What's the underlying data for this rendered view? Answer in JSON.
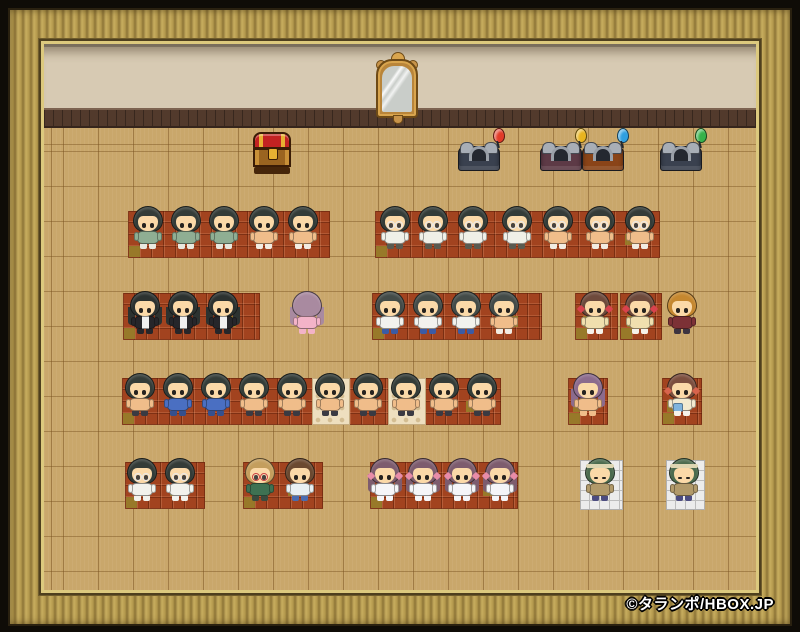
{
  "game": {
    "copyright": "©タランポ/HBOX.JP"
  },
  "palette": {
    "outer_bg": "#0f0c07",
    "frame_gold": "#b4994d",
    "wall": "#d7cab3",
    "baseboard": "#523a2c",
    "floor": "#c9a76b",
    "red_tile": "#a2431f",
    "olive_tile": "#97802a",
    "cream_tile": "#eedfbf",
    "white_mat": "#ececec",
    "skin": "#f5cb98"
  },
  "objects": {
    "mirror": {
      "name": "wall-mirror",
      "x": 374,
      "y": 50
    },
    "chest": {
      "name": "treasure-chest",
      "x": 253,
      "y": 132
    },
    "beds": [
      {
        "x": 457,
        "y": 140,
        "base": "#3a414f",
        "marker_color": "#e23b28",
        "marker_icon": "red-balloon-icon"
      },
      {
        "x": 539,
        "y": 140,
        "base": "#5d3a46",
        "marker_color": "#e9b41f",
        "marker_icon": "yellow-balloon-icon"
      },
      {
        "x": 581,
        "y": 140,
        "base": "#8a4418",
        "marker_color": "#2f9fe0",
        "marker_icon": "blue-balloon-icon"
      },
      {
        "x": 659,
        "y": 140,
        "base": "#3a414f",
        "marker_color": "#35b24a",
        "marker_icon": "green-balloon-icon"
      }
    ]
  },
  "tiles": {
    "red_blocks": [
      {
        "x": 128,
        "y": 211,
        "w": 202,
        "h": 47
      },
      {
        "x": 375,
        "y": 211,
        "w": 285,
        "h": 47
      },
      {
        "x": 123,
        "y": 293,
        "w": 137,
        "h": 47
      },
      {
        "x": 372,
        "y": 293,
        "w": 170,
        "h": 47
      },
      {
        "x": 575,
        "y": 293,
        "w": 43,
        "h": 47
      },
      {
        "x": 620,
        "y": 293,
        "w": 42,
        "h": 47
      },
      {
        "x": 122,
        "y": 378,
        "w": 379,
        "h": 47
      },
      {
        "x": 568,
        "y": 378,
        "w": 40,
        "h": 47
      },
      {
        "x": 662,
        "y": 378,
        "w": 40,
        "h": 47
      },
      {
        "x": 125,
        "y": 462,
        "w": 80,
        "h": 47
      },
      {
        "x": 243,
        "y": 462,
        "w": 80,
        "h": 47
      },
      {
        "x": 370,
        "y": 462,
        "w": 148,
        "h": 47
      }
    ],
    "cream_tiles": [
      {
        "x": 312,
        "y": 378,
        "w": 38,
        "h": 47
      },
      {
        "x": 388,
        "y": 378,
        "w": 38,
        "h": 47
      }
    ],
    "white_mats": [
      {
        "x": 580,
        "y": 460,
        "w": 43,
        "h": 50
      },
      {
        "x": 666,
        "y": 460,
        "w": 39,
        "h": 50
      }
    ]
  },
  "sprites": {
    "rows": {
      "1": 206,
      "2": 291,
      "3": 373,
      "4": 458
    },
    "skin": "#f5cb98",
    "face": "#fbd9a8",
    "types": {
      "boy_green": {
        "hair": "#343c38",
        "top": "#8fae93",
        "legs": "#e9e9df"
      },
      "boy_shirtless": {
        "hair": "#343c38",
        "top": "#f0bd8a",
        "legs": "#f2ece2"
      },
      "glasses_clothed": {
        "hair": "#343c38",
        "glasses": "#e8e8e8",
        "top": "#f0f0e8",
        "legs": "#5a5a50"
      },
      "glasses_shirtless": {
        "hair": "#343c38",
        "glasses": "#e8e8e8",
        "top": "#f0bd8a",
        "legs": "#f2ece2"
      },
      "suit": {
        "hair": "#2c3230",
        "long": true,
        "top": "#26262a",
        "stripe": "#f0f0f0",
        "legs": "#26262a"
      },
      "pink_back": {
        "hair": "#a98aa0",
        "back": true,
        "long": true,
        "top": "#f3b3c8",
        "legs": "#f3b3c8"
      },
      "tee_jeans": {
        "hair": "#434b48",
        "top": "#f2f2ee",
        "legs": "#3b5ba5"
      },
      "gray_shirtless": {
        "hair": "#434b48",
        "top": "#f0bd8a",
        "legs": "#f2ece2"
      },
      "yellow_dress": {
        "hair": "#6e4a3c",
        "ribbon": "#d8434d",
        "top": "#f0dfae",
        "legs": "#f6f2ea"
      },
      "gold_spiky": {
        "hair": "#c5872f",
        "top": "#7c3136",
        "legs": "#3c3440"
      },
      "blue_jacket": {
        "hair": "#343c38",
        "top": "#4a6fc2",
        "legs": "#35508e"
      },
      "dark_shirtless": {
        "hair": "#343c38",
        "top": "#f0bd8a",
        "legs": "#3a3a42"
      },
      "purple_long": {
        "hair": "#8c6b8d",
        "long": true,
        "top": "#f0bd8a",
        "legs": "#f0bd8a"
      },
      "pigtail_girl": {
        "hair": "#7c4e3e",
        "ribbon": "#d8644d",
        "top": "#f2ead0",
        "accent": "#7fb4dd",
        "legs": "#f6f2ea"
      },
      "glasses_dress": {
        "hair": "#343c38",
        "glasses": "#e8e8e8",
        "top": "#f2f2ec",
        "legs": "#f2f2ec"
      },
      "blonde_glasses": {
        "hair": "#c49e5d",
        "glasses": "#cc4444",
        "top": "#3e7152",
        "legs": "#3a4a3e"
      },
      "brown_casual": {
        "hair": "#6b4930",
        "top": "#e9f0f2",
        "legs": "#4a6cb0"
      },
      "purple_dress": {
        "hair": "#7d5c6e",
        "long": true,
        "ribbon": "#e88ca8",
        "top": "#f5f5f8",
        "legs": "#f5f5f8"
      },
      "green_monk": {
        "hair": "#4c6b4e",
        "band": "#ded6b2",
        "eyes": "closed",
        "top": "#b29a6a",
        "legs": "#4c4c80"
      }
    },
    "characters": [
      {
        "x": 148,
        "row": 1,
        "type": "boy_green"
      },
      {
        "x": 186,
        "row": 1,
        "type": "boy_green"
      },
      {
        "x": 224,
        "row": 1,
        "type": "boy_green"
      },
      {
        "x": 264,
        "row": 1,
        "type": "boy_shirtless"
      },
      {
        "x": 303,
        "row": 1,
        "type": "boy_shirtless"
      },
      {
        "x": 395,
        "row": 1,
        "type": "glasses_clothed"
      },
      {
        "x": 433,
        "row": 1,
        "type": "glasses_clothed"
      },
      {
        "x": 473,
        "row": 1,
        "type": "glasses_clothed"
      },
      {
        "x": 517,
        "row": 1,
        "type": "glasses_clothed"
      },
      {
        "x": 558,
        "row": 1,
        "type": "glasses_shirtless"
      },
      {
        "x": 600,
        "row": 1,
        "type": "glasses_shirtless"
      },
      {
        "x": 640,
        "row": 1,
        "type": "glasses_shirtless"
      },
      {
        "x": 145,
        "row": 2,
        "type": "suit"
      },
      {
        "x": 183,
        "row": 2,
        "type": "suit"
      },
      {
        "x": 223,
        "row": 2,
        "type": "suit"
      },
      {
        "x": 307,
        "row": 2,
        "type": "pink_back"
      },
      {
        "x": 390,
        "row": 2,
        "type": "tee_jeans"
      },
      {
        "x": 428,
        "row": 2,
        "type": "tee_jeans"
      },
      {
        "x": 466,
        "row": 2,
        "type": "tee_jeans"
      },
      {
        "x": 504,
        "row": 2,
        "type": "gray_shirtless"
      },
      {
        "x": 595,
        "row": 2,
        "type": "yellow_dress"
      },
      {
        "x": 640,
        "row": 2,
        "type": "yellow_dress"
      },
      {
        "x": 682,
        "row": 2,
        "type": "gold_spiky"
      },
      {
        "x": 140,
        "row": 3,
        "type": "dark_shirtless"
      },
      {
        "x": 178,
        "row": 3,
        "type": "blue_jacket"
      },
      {
        "x": 216,
        "row": 3,
        "type": "blue_jacket"
      },
      {
        "x": 254,
        "row": 3,
        "type": "dark_shirtless"
      },
      {
        "x": 292,
        "row": 3,
        "type": "dark_shirtless"
      },
      {
        "x": 330,
        "row": 3,
        "type": "dark_shirtless"
      },
      {
        "x": 368,
        "row": 3,
        "type": "dark_shirtless"
      },
      {
        "x": 406,
        "row": 3,
        "type": "dark_shirtless"
      },
      {
        "x": 444,
        "row": 3,
        "type": "dark_shirtless"
      },
      {
        "x": 482,
        "row": 3,
        "type": "dark_shirtless"
      },
      {
        "x": 588,
        "row": 3,
        "type": "purple_long"
      },
      {
        "x": 682,
        "row": 3,
        "type": "pigtail_girl"
      },
      {
        "x": 142,
        "row": 4,
        "type": "glasses_dress"
      },
      {
        "x": 180,
        "row": 4,
        "type": "glasses_dress"
      },
      {
        "x": 260,
        "row": 4,
        "type": "blonde_glasses"
      },
      {
        "x": 300,
        "row": 4,
        "type": "brown_casual"
      },
      {
        "x": 385,
        "row": 4,
        "type": "purple_dress"
      },
      {
        "x": 423,
        "row": 4,
        "type": "purple_dress"
      },
      {
        "x": 462,
        "row": 4,
        "type": "purple_dress"
      },
      {
        "x": 500,
        "row": 4,
        "type": "purple_dress"
      },
      {
        "x": 600,
        "row": 4,
        "type": "green_monk"
      },
      {
        "x": 684,
        "row": 4,
        "type": "green_monk"
      }
    ]
  }
}
